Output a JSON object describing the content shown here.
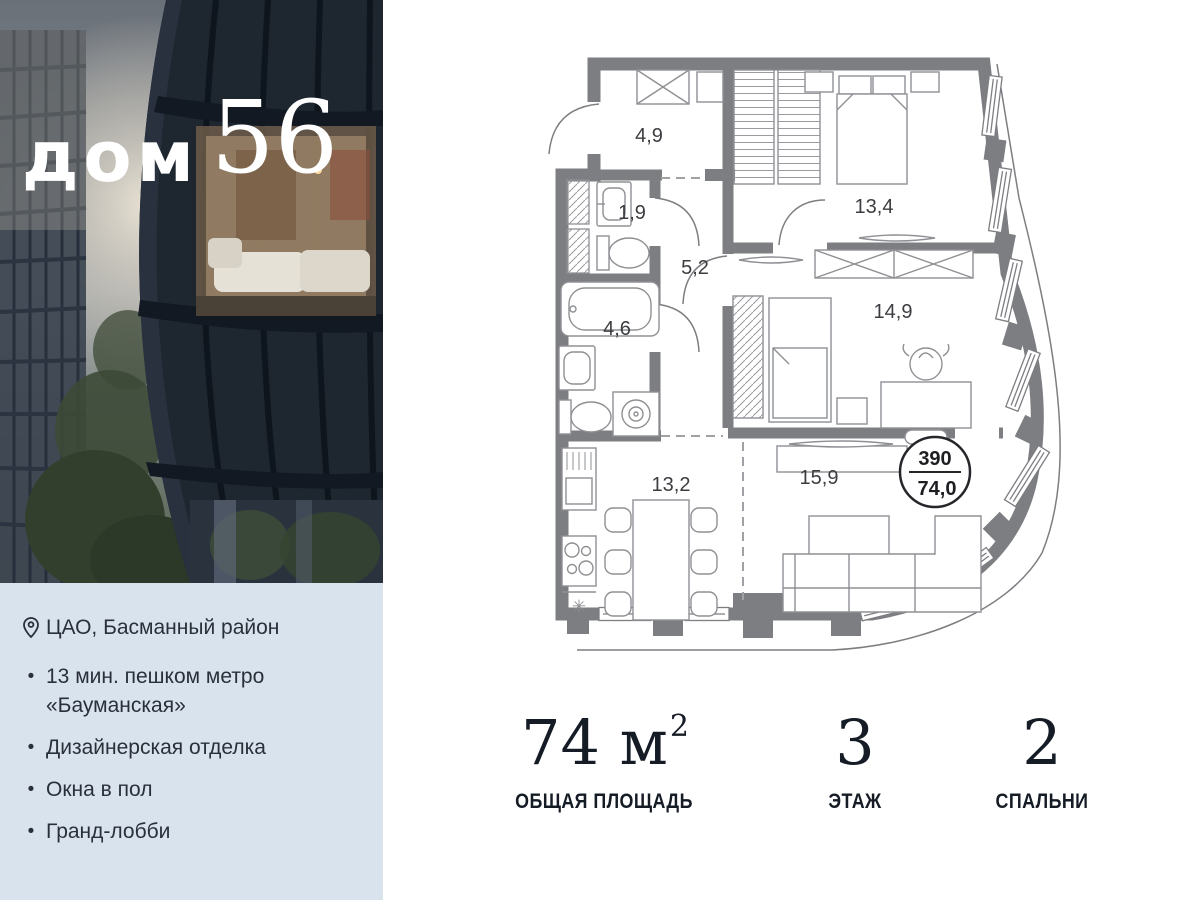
{
  "logo": {
    "word": "дом",
    "number": "56"
  },
  "features": {
    "location": "ЦАО, Басманный район",
    "bullet": "•",
    "items": [
      "13 мин. пешком метро «Бауманская»",
      "Дизайнерская отделка",
      "Окна в пол",
      "Гранд-лобби"
    ]
  },
  "floorplan": {
    "rooms": [
      {
        "name": "hallway",
        "area": "4,9"
      },
      {
        "name": "wc",
        "area": "1,9"
      },
      {
        "name": "corridor",
        "area": "5,2"
      },
      {
        "name": "bathroom",
        "area": "4,6"
      },
      {
        "name": "bedroom-1",
        "area": "13,4"
      },
      {
        "name": "bedroom-2",
        "area": "14,9"
      },
      {
        "name": "kitchen",
        "area": "13,2"
      },
      {
        "name": "living",
        "area": "15,9"
      }
    ],
    "badge": {
      "top": "390",
      "bottom": "74,0"
    },
    "fridge_symbol": "✳"
  },
  "stats": [
    {
      "value": "74 м",
      "sup": "2",
      "label": "ОБЩАЯ ПЛОЩАДЬ"
    },
    {
      "value": "3",
      "sup": "",
      "label": "ЭТАЖ"
    },
    {
      "value": "2",
      "sup": "",
      "label": "СПАЛЬНИ"
    }
  ],
  "colors": {
    "panel": "#d9e3ed",
    "wall": "#7d7e82",
    "text_dark": "#161c26"
  }
}
